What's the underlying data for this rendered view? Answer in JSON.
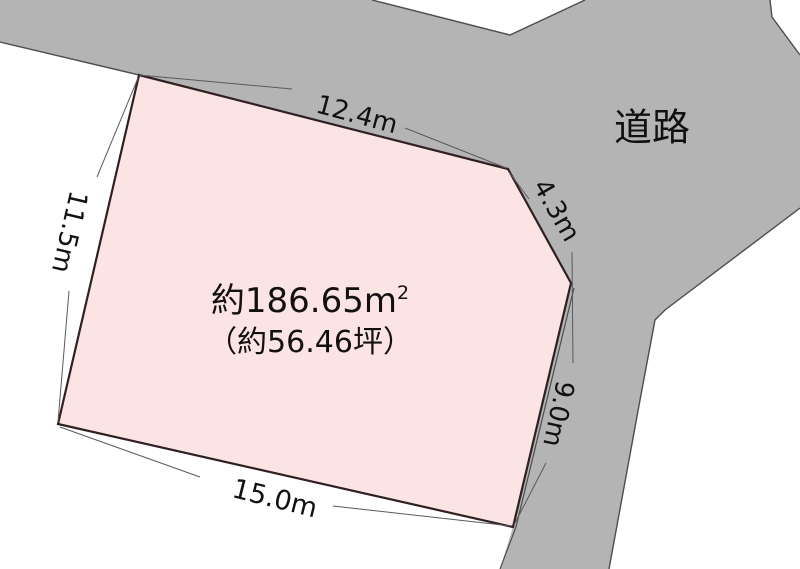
{
  "diagram": {
    "road_label": "道路",
    "area_line1": "約186.65m",
    "area_line1_sup": "2",
    "area_line2": "（約56.46坪）",
    "dimensions": {
      "top": "12.4m",
      "top_right": "4.3m",
      "right": "9.0m",
      "bottom": "15.0m",
      "left": "11.5m"
    }
  },
  "colors": {
    "background": "#ffffff",
    "road_fill": "#b4b4b4",
    "road_line": "#4d4d4d",
    "parcel_fill": "#fce4e4",
    "parcel_border": "#2f2121",
    "leader_line": "#5a5a5a",
    "text": "#111111"
  }
}
